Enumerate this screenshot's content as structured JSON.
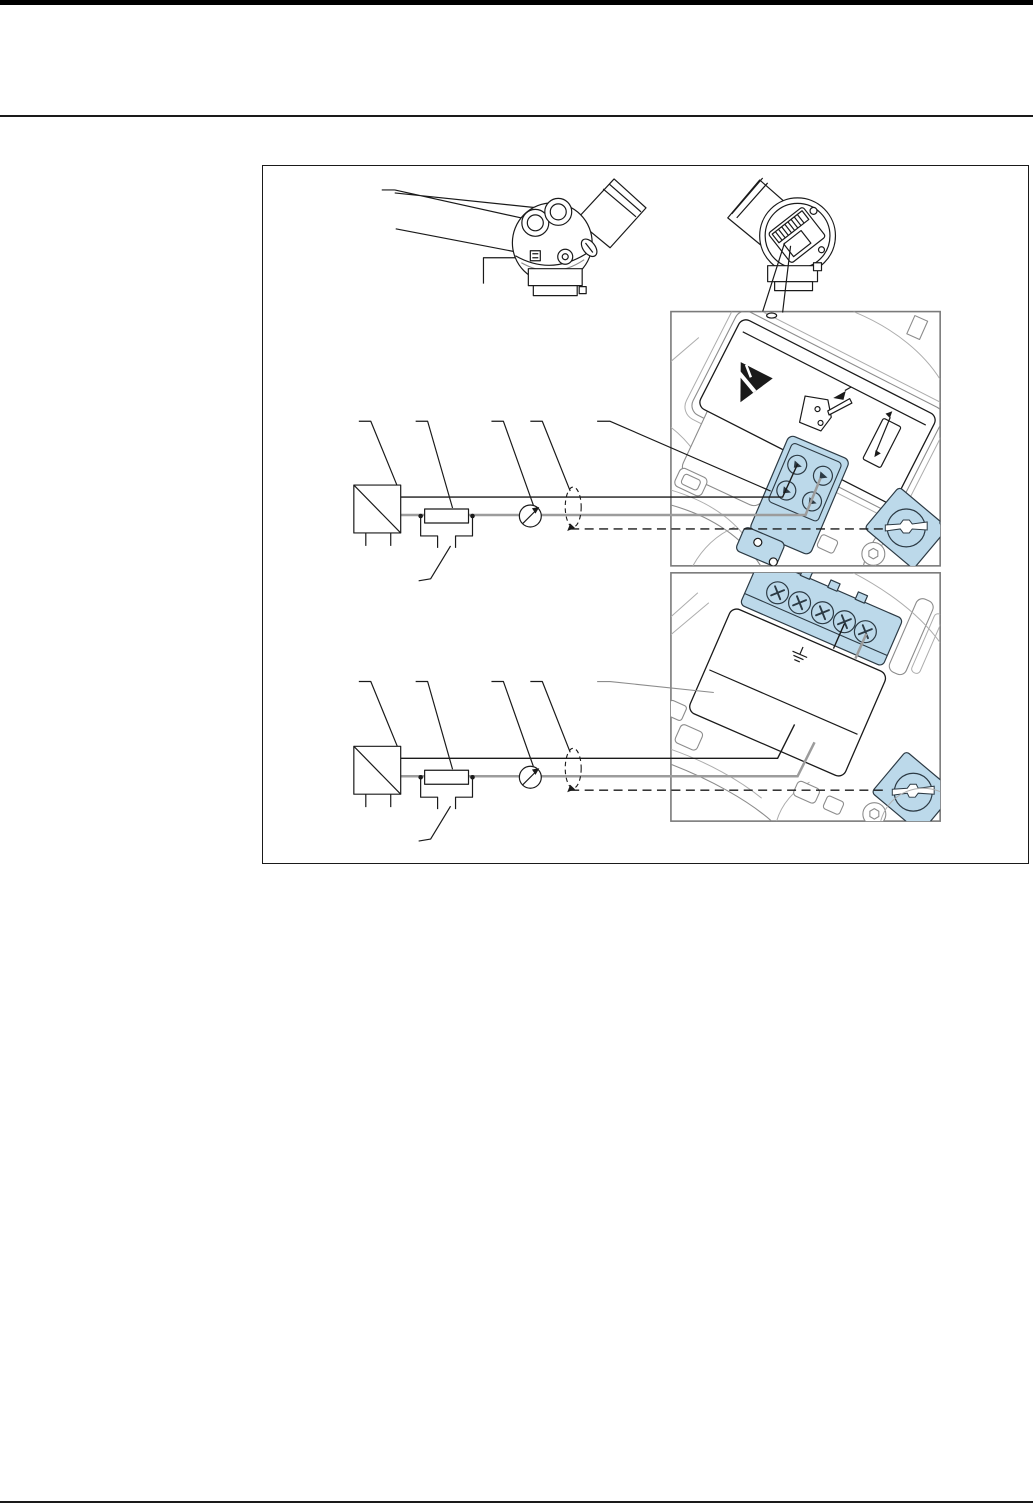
{
  "page": {
    "width": 1033,
    "height": 1506
  },
  "colors": {
    "page_bg": "#ffffff",
    "topbar": "#000000",
    "rule": "#1a1a1a",
    "line_black": "#1a1a1a",
    "contour_gray": "#8c8c8c",
    "contour_light": "#adadad",
    "wire_gray": "#9c9c9c",
    "detail_border": "#7a7a7a",
    "accent_blue": "#bcd9ea",
    "screw_blue": "#cfe3ef",
    "blue_stroke": "#2c3a44"
  },
  "figure": {
    "type": "technical-wiring-diagram",
    "views": [
      "transmitter-side-view",
      "transmitter-terminal-view",
      "upper-terminal-compartment-detail",
      "lower-terminal-compartment-detail",
      "supply-wiring-schematic-top",
      "supply-wiring-schematic-bottom"
    ],
    "icons": [
      "esd-warning-icon",
      "ground-symbol-icon",
      "ammeter-icon",
      "cable-shield-icon",
      "power-supply-icon",
      "ground-screw-icon",
      "torx-screw-icon",
      "phillips-screw-icon",
      "wire-clamp-icon",
      "double-arrow-icon",
      "cable-gland-icon"
    ]
  }
}
